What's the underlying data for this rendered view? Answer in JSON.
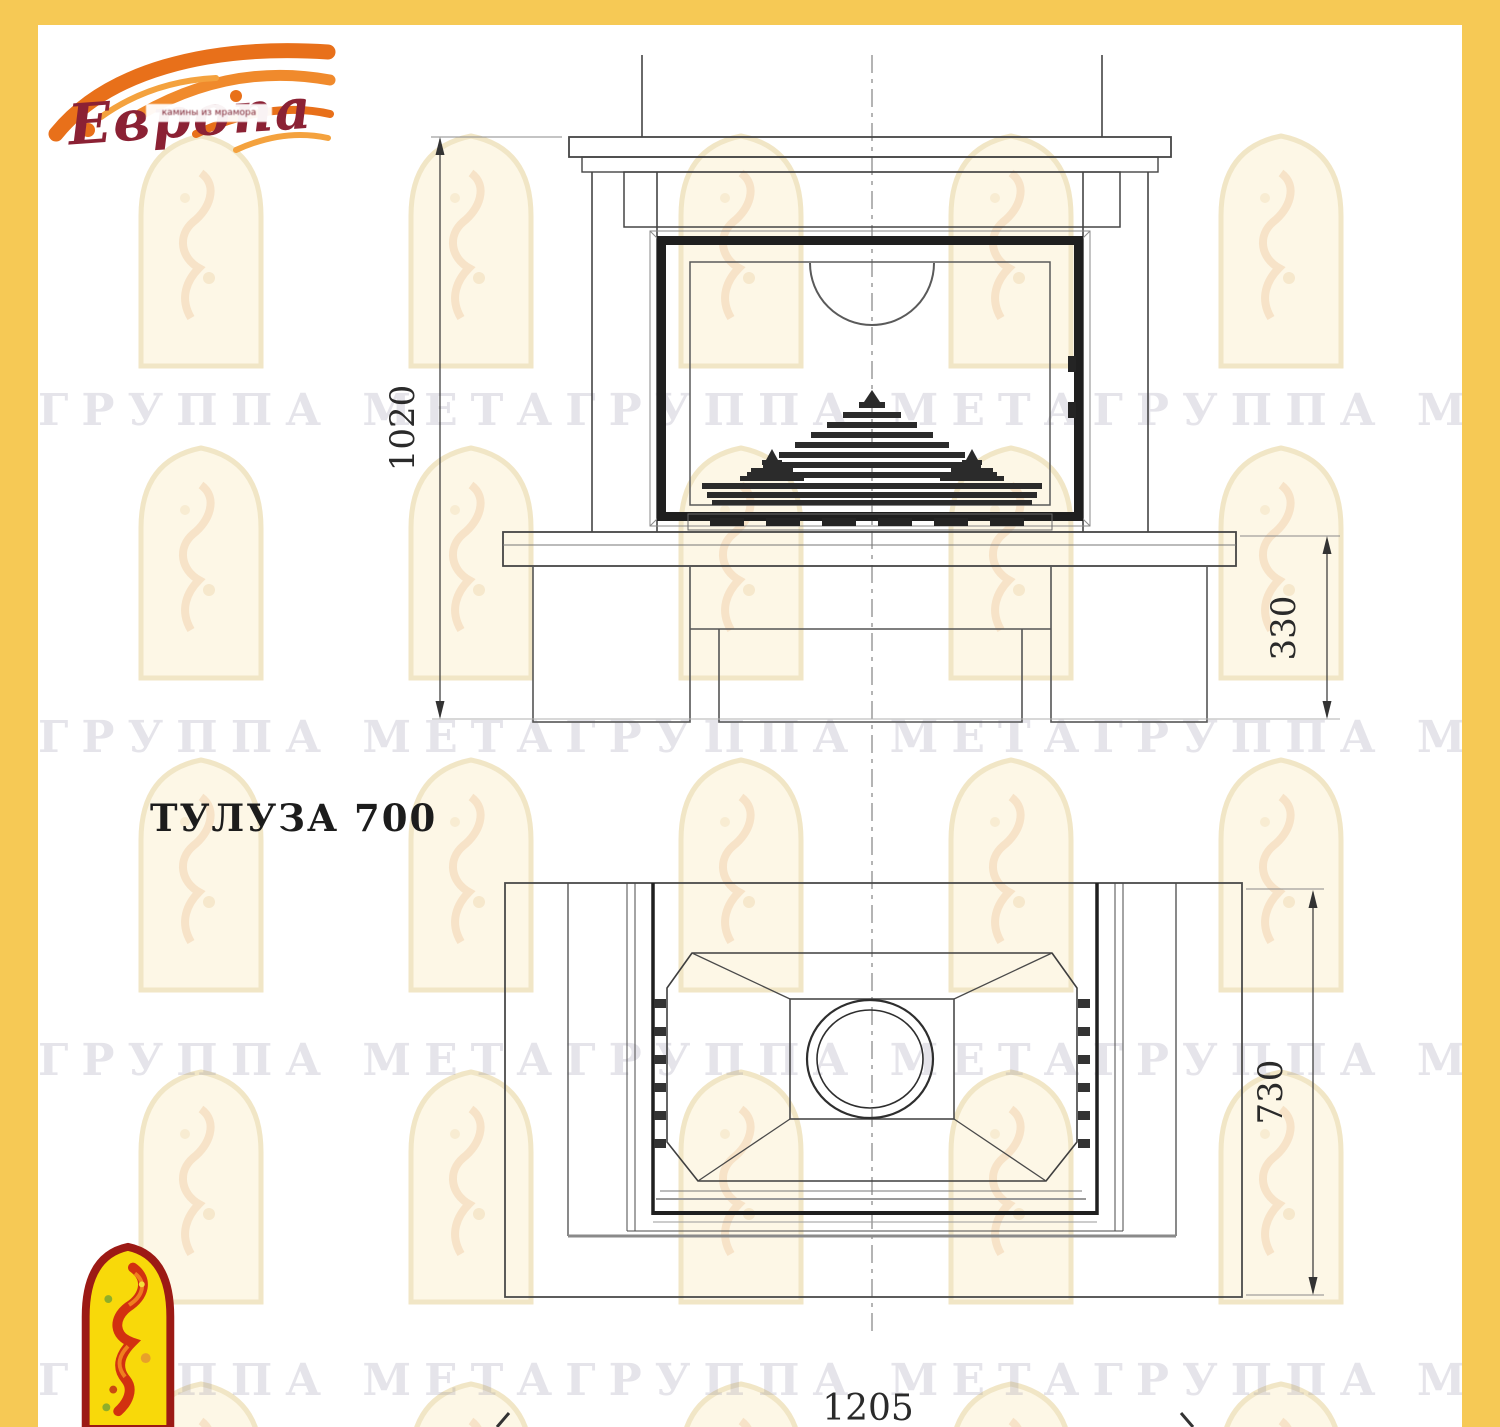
{
  "title": "ТУЛУЗА 700",
  "logo": {
    "brand": "Европа",
    "tagline": "камины из мрамора",
    "flame_color": "#e8701a",
    "brand_text_color": "#8b2134"
  },
  "watermark": {
    "text": "ГРУППА МЕТАГРУППА МЕТАГРУППА МЕТА",
    "arch_fill": "#fdf7e6",
    "arch_border": "#f1e6c6",
    "text_color": "rgba(126,122,148,0.20)"
  },
  "frame_color": "#f6c955",
  "front_view": {
    "name": "front elevation of fireplace",
    "height_mm": "1020",
    "base_height_mm": "330"
  },
  "plan_view": {
    "name": "plan (top) view of fireplace",
    "depth_mm": "730",
    "width_mm": "1205"
  }
}
